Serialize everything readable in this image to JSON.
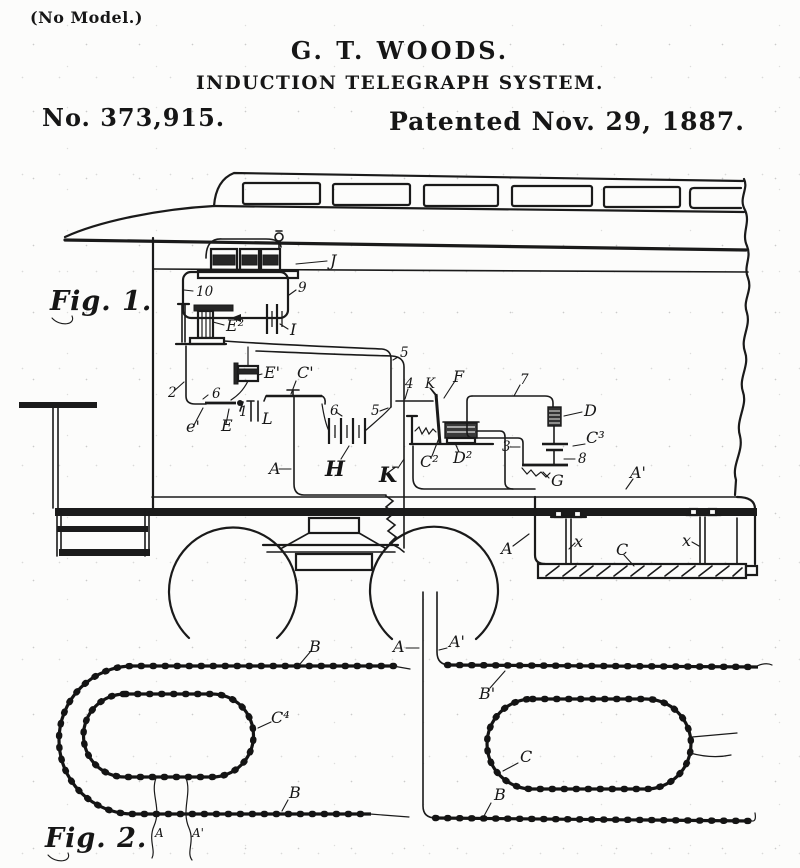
{
  "colors": {
    "ink": "#1a1a1a",
    "paper": "#fcfcfb"
  },
  "header": {
    "no_model": "(No Model.)",
    "inventor": "G. T. WOODS.",
    "title": "INDUCTION TELEGRAPH SYSTEM.",
    "patent_number": "No. 373,915.",
    "patent_date": "Patented Nov. 29, 1887."
  },
  "fig1": {
    "caption": "Fig. 1.",
    "labels": {
      "J": "J",
      "n10": "10",
      "n9": "9",
      "I": "I",
      "E2": "E²",
      "n2": "2",
      "n6a": "6",
      "e1": "e'",
      "E": "E",
      "n1": "1",
      "L": "L",
      "E1": "E'",
      "C1": "C'",
      "n6b": "6",
      "H": "H",
      "n5a": "5",
      "n5b": "5",
      "n4": "4",
      "Ks": "K",
      "F": "F",
      "Kb": "K",
      "C2": "C²",
      "D2": "D²",
      "n7": "7",
      "D": "D",
      "C3": "C³",
      "n3": "3",
      "n8": "8",
      "G": "G",
      "A": "A",
      "A1": "A'",
      "Au": "A",
      "x1": "x",
      "x2": "x",
      "C": "C"
    }
  },
  "fig2": {
    "caption": "Fig. 2.",
    "labels": {
      "Bt": "B",
      "A": "A",
      "A1": "A'",
      "C4": "C⁴",
      "Bb": "B",
      "B1": "B'",
      "C": "C",
      "Br": "B",
      "a": "A",
      "a1": "A'"
    }
  }
}
